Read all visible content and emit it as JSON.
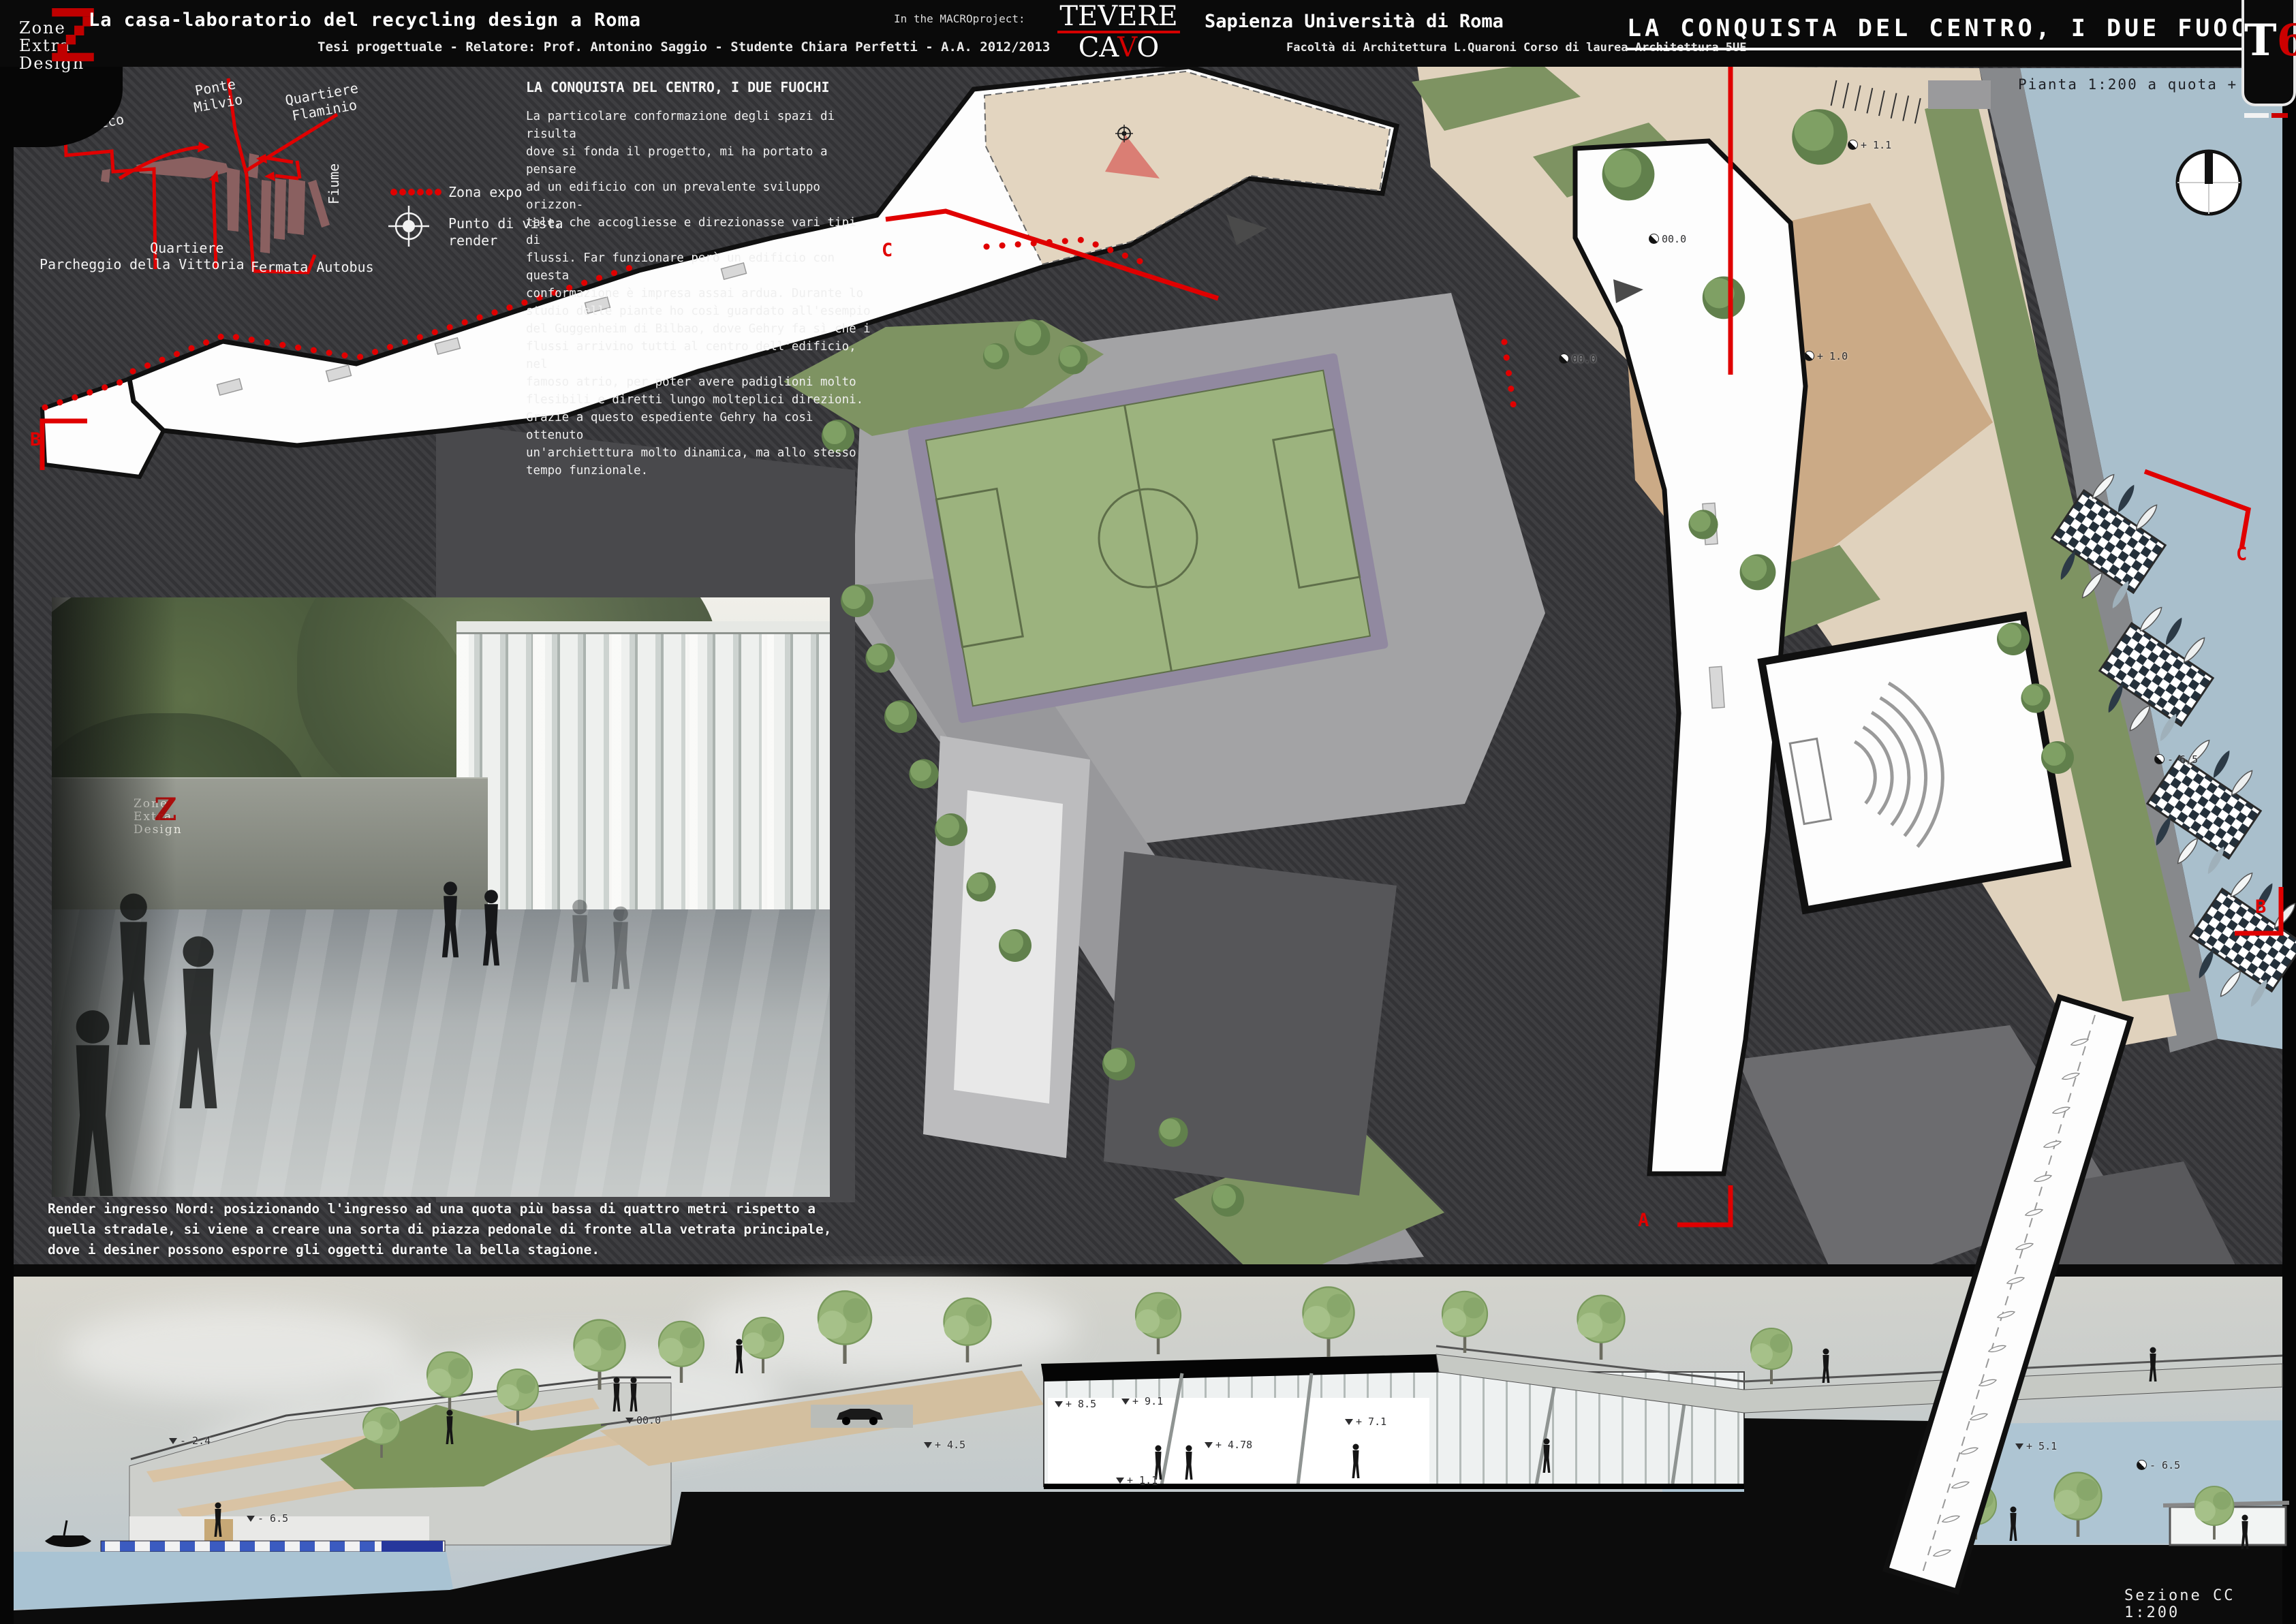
{
  "header": {
    "logo": {
      "lines": [
        "Zone",
        "Extra",
        "Design"
      ],
      "accent": "Z"
    },
    "title": "La casa-laboratorio del recycling design a Roma",
    "subtitle": "Tesi progettuale - Relatore: Prof. Antonino Saggio - Studente Chiara Perfetti - A.A. 2012/2013",
    "macro": {
      "label": "In the MACROproject:",
      "logo_top": "TEVERE",
      "cavo_pre": "CA",
      "cavo_accent": "V",
      "cavo_post": "O"
    },
    "university": {
      "name": "Sapienza Università di Roma",
      "faculty": "Facoltà di Architettura L.Quaroni Corso di laurea Architettura 5UE"
    },
    "board_title": "LA CONQUISTA DEL CENTRO, I DUE FUOCHI",
    "board_code": {
      "letter": "T",
      "number": "6"
    }
  },
  "site_map": {
    "labels": [
      {
        "text": "Foro\nItalico"
      },
      {
        "text": "Ponte\nMilvio"
      },
      {
        "text": "Quartiere\nFlaminio"
      },
      {
        "text": "Parcheggio"
      },
      {
        "text": "Quartiere\ndella Vittoria"
      },
      {
        "text": "Fermata Autobus"
      },
      {
        "text": "Fiume"
      }
    ],
    "legend": [
      {
        "label": "Zona expo"
      },
      {
        "label": "Punto di vista\nrender"
      }
    ]
  },
  "description": {
    "title": "LA CONQUISTA DEL CENTRO, I DUE FUOCHI",
    "body": "La particolare conformazione degli spazi di risulta\ndove si fonda il progetto, mi ha portato a pensare\nad un edificio con un prevalente sviluppo orizzon-\ntale, che accogliesse e direzionasse vari tipi di\nflussi. Far funzionare però un edificio con questa\nconformazione è impresa assai ardua. Durante lo\nstudio delle piante ho così guardato all'esempio\ndel Guggenheim di Bilbao, dove Gehry fa sì che i\nflussi arrivino tutti al centro dell'edificio, nel\nfamoso atrio, per poter avere padiglioni molto\nflesibili e diretti lungo molteplici direzioni.\nGrazie a questo espediente Gehry ha così ottenuto\nun'archietttura molto dinamica, ma allo stesso\ntempo funzionale."
  },
  "plan": {
    "caption": "Pianta 1:200 a quota + 1.5",
    "markers": {
      "a_top": "A",
      "a_bottom": "A",
      "b_left": "B",
      "b_right": "B",
      "c_left": "C",
      "c_right": "C"
    },
    "levels": [
      {
        "text": "+ 1.1"
      },
      {
        "text": "00.0"
      },
      {
        "text": "00.0"
      },
      {
        "text": "+ 1.0"
      },
      {
        "text": "- 6.5"
      }
    ]
  },
  "render": {
    "wall_logo": {
      "lines": [
        "Zone",
        "Extra",
        "Design"
      ],
      "accent": "Z"
    },
    "caption": "Render ingresso Nord: posizionando l'ingresso ad una quota più bassa di quattro metri rispetto a\nquella stradale, si viene a creare una sorta di piazza pedonale di fronte alla vetrata principale,\ndove i desiner possono esporre gli oggetti durante la bella stagione."
  },
  "section": {
    "caption": "Sezione CC 1:200",
    "levels": [
      {
        "text": "- 2.4"
      },
      {
        "text": "- 6.5"
      },
      {
        "text": "00.0"
      },
      {
        "text": "+ 4.5"
      },
      {
        "text": "+ 8.5"
      },
      {
        "text": "+ 9.1"
      },
      {
        "text": "+ 4.78"
      },
      {
        "text": "+ 1.1"
      },
      {
        "text": "+ 7.1"
      },
      {
        "text": "+ 5.1"
      },
      {
        "text": "- 6.5"
      }
    ]
  },
  "colors": {
    "accent_red": "#e00000",
    "river": "#a9bfcc",
    "field_green": "#9cb37e",
    "paving_tan": "#e0d2bd"
  }
}
